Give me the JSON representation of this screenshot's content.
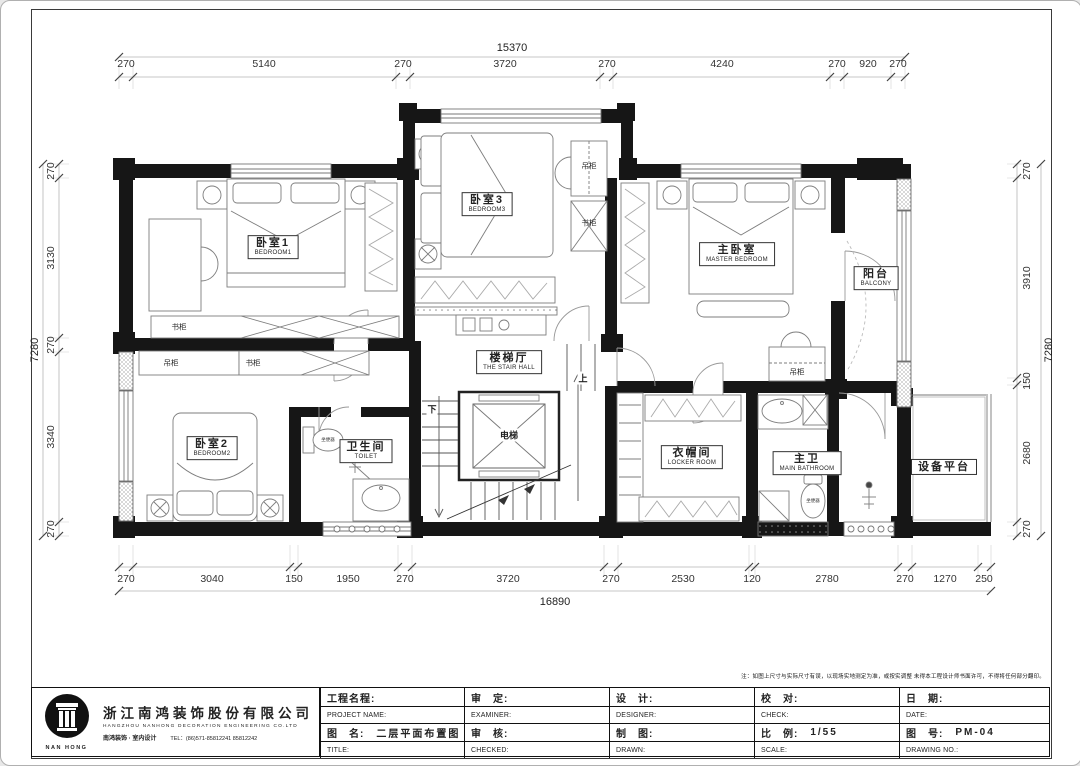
{
  "frame": {
    "note": "注：如图上尺寸与实际尺寸有误，以现场实地测定为准，或按实调整 未得本工程设计师书面许可，不得将任何部分翻印。"
  },
  "dims": {
    "top": {
      "total": "15370",
      "segments": [
        "270",
        "5140",
        "270",
        "3720",
        "270",
        "4240",
        "270",
        "920",
        "270"
      ]
    },
    "bottom": {
      "total": "16890",
      "segments": [
        "270",
        "3040",
        "150",
        "1950",
        "270",
        "3720",
        "270",
        "2530",
        "120",
        "2780",
        "270",
        "1270",
        "250"
      ]
    },
    "left": {
      "total": "7280",
      "segments": [
        "270",
        "3130",
        "270",
        "3340",
        "270"
      ]
    },
    "right": {
      "total": "7280",
      "segments": [
        "270",
        "3910",
        "150",
        "2680",
        "270"
      ]
    }
  },
  "rooms": {
    "bedroom1": {
      "cn": "卧室1",
      "en": "BEDROOM1"
    },
    "bedroom2": {
      "cn": "卧室2",
      "en": "BEDROOM2"
    },
    "bedroom3": {
      "cn": "卧室3",
      "en": "BEDROOM3"
    },
    "master": {
      "cn": "主卧室",
      "en": "MASTER BEDROOM"
    },
    "balcony": {
      "cn": "阳台",
      "en": "BALCONY"
    },
    "stair_hall": {
      "cn": "楼梯厅",
      "en": "THE STAIR HALL"
    },
    "toilet": {
      "cn": "卫生间",
      "en": "TOILET"
    },
    "locker": {
      "cn": "衣帽间",
      "en": "LOCKER ROOM"
    },
    "main_bath": {
      "cn": "主卫",
      "en": "MAIN BATHROOM"
    },
    "equipment": {
      "cn": "设备平台",
      "en": ""
    }
  },
  "labels": {
    "bookcase": "书柜",
    "hanging_cabinet": "吊柜",
    "elevator": "电梯",
    "up": "上",
    "down": "下",
    "wc": "坐便器"
  },
  "company": {
    "logo_text": "NAN HONG",
    "name_cn": "浙江南鸿装饰股份有限公司",
    "name_en": "HANGZHOU NANHONG DECORATION ENGINEERING CO.LTD",
    "tagline": "南鸿装饰 · 室内设计",
    "tel": "TEL：(86)571-85812241  85812242"
  },
  "title_block": {
    "cells": [
      {
        "cn": "工程名程:",
        "en": "PROJECT NAME:",
        "value": ""
      },
      {
        "cn": "审　定:",
        "en": "EXAMINER:",
        "value": ""
      },
      {
        "cn": "设　计:",
        "en": "DESIGNER:",
        "value": ""
      },
      {
        "cn": "校　对:",
        "en": "CHECK:",
        "value": ""
      },
      {
        "cn": "日　期:",
        "en": "DATE:",
        "value": ""
      },
      {
        "cn": "图　名:",
        "en": "TITLE:",
        "value": "二层平面布置图"
      },
      {
        "cn": "审　核:",
        "en": "CHECKED:",
        "value": ""
      },
      {
        "cn": "制　图:",
        "en": "DRAWN:",
        "value": ""
      },
      {
        "cn": "比　例:",
        "en": "SCALE:",
        "value": "1/55"
      },
      {
        "cn": "图　号:",
        "en": "DRAWING NO.:",
        "value": "PM-04"
      }
    ]
  }
}
